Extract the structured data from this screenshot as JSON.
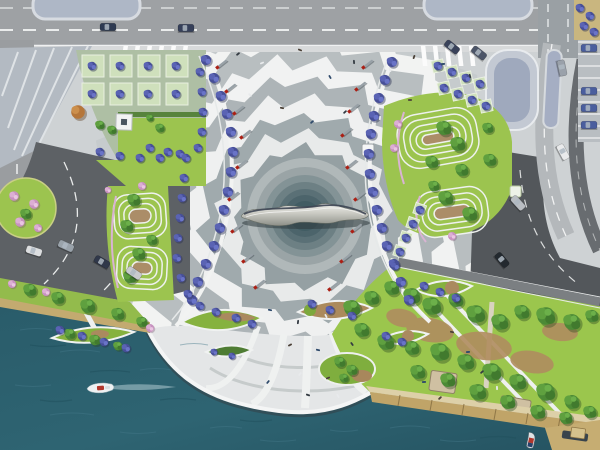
{
  "meta": {
    "title": "Aerial masterplan rendering: waterfront civic plaza with ripple paving, central metallic sculpture, landscaped terraces, roads and harbour",
    "view": "top-down site plan"
  },
  "palette": {
    "plaza_base": "#ced2d4",
    "plaza_white": "#f2f3f2",
    "plaza_gray": "#b4babc",
    "water": "#2c606e",
    "lawn": "#9cc44f",
    "road_light": "#9ea1a4",
    "road_dark": "#5d6165",
    "beach": "#c3aa70",
    "boardwalk": "#c0a468",
    "tree_green": "#4f8f3a",
    "tree_blue": "#5b62aa",
    "tree_pink": "#d9aed2",
    "mast_red": "#ab1f14",
    "metal": "#c9c9c2"
  },
  "scene": {
    "ripple": {
      "cx": 305,
      "cy": 218,
      "rings": [
        {
          "r": 208,
          "amp": 16,
          "teeth": 27,
          "rot": 4,
          "color": "#c6cbcd"
        },
        {
          "r": 188,
          "amp": 15,
          "teeth": 25,
          "rot": 11,
          "color": "#f2f3f2"
        },
        {
          "r": 168,
          "amp": 15,
          "teeth": 23,
          "rot": 1,
          "color": "#b8bec0"
        },
        {
          "r": 149,
          "amp": 14,
          "teeth": 21,
          "rot": 8,
          "color": "#f1f2f2"
        },
        {
          "r": 131,
          "amp": 13,
          "teeth": 19,
          "rot": 15,
          "color": "#adb4b7"
        },
        {
          "r": 113,
          "amp": 12,
          "teeth": 17,
          "rot": 5,
          "color": "#eff0f0"
        },
        {
          "r": 96,
          "amp": 11,
          "teeth": 15,
          "rot": 12,
          "color": "#a0aaad"
        },
        {
          "r": 80,
          "amp": 10,
          "teeth": 13,
          "rot": 3,
          "color": "#e8eaea"
        },
        {
          "r": 65,
          "amp": 9,
          "teeth": 12,
          "rot": 9,
          "color": "#95a0a3"
        }
      ],
      "core": [
        [
          58,
          "#b0b8b9"
        ],
        [
          49,
          "#9aa4a6"
        ],
        [
          41,
          "#839396"
        ],
        [
          34,
          "#6d8084"
        ],
        [
          27,
          "#5a7076"
        ],
        [
          21,
          "#4c646b"
        ],
        [
          15,
          "#415c63"
        ]
      ]
    },
    "masts": [
      [
        222,
        64
      ],
      [
        231,
        88
      ],
      [
        239,
        110
      ],
      [
        246,
        134
      ],
      [
        242,
        164
      ],
      [
        234,
        196
      ],
      [
        237,
        228
      ],
      [
        248,
        258
      ],
      [
        260,
        284
      ],
      [
        368,
        64
      ],
      [
        361,
        86
      ],
      [
        354,
        108
      ],
      [
        347,
        132
      ],
      [
        352,
        164
      ],
      [
        360,
        196
      ],
      [
        357,
        228
      ],
      [
        346,
        258
      ],
      [
        334,
        286
      ]
    ],
    "cars": [
      [
        108,
        27,
        0,
        "#2e3a52"
      ],
      [
        186,
        28,
        0,
        "#36405a"
      ],
      [
        452,
        47,
        38,
        "#39425a"
      ],
      [
        479,
        53,
        38,
        "#4c5568"
      ],
      [
        563,
        152,
        62,
        "#e9eaeb"
      ],
      [
        518,
        203,
        48,
        "#b9bdc2"
      ],
      [
        562,
        68,
        78,
        "#9aa1aa"
      ],
      [
        34,
        251,
        18,
        "#dcdee0"
      ],
      [
        66,
        246,
        24,
        "#9aa3ab"
      ],
      [
        102,
        262,
        30,
        "#30384a"
      ],
      [
        134,
        273,
        34,
        "#c8cace"
      ],
      [
        502,
        260,
        50,
        "#23292f"
      ]
    ],
    "parked_cars": [
      [
        589,
        48
      ],
      [
        589,
        91
      ],
      [
        589,
        108
      ],
      [
        589,
        125
      ]
    ],
    "people": [
      [
        238,
        54
      ],
      [
        262,
        63
      ],
      [
        300,
        50
      ],
      [
        330,
        77
      ],
      [
        354,
        62
      ],
      [
        390,
        70
      ],
      [
        414,
        57
      ],
      [
        443,
        64
      ],
      [
        470,
        76
      ],
      [
        250,
        95
      ],
      [
        282,
        108
      ],
      [
        312,
        122
      ],
      [
        345,
        112
      ],
      [
        380,
        118
      ],
      [
        410,
        100
      ],
      [
        270,
        310
      ],
      [
        298,
        322
      ],
      [
        326,
        316
      ],
      [
        290,
        345
      ],
      [
        318,
        350
      ],
      [
        352,
        344
      ],
      [
        300,
        374
      ],
      [
        328,
        378
      ],
      [
        268,
        382
      ],
      [
        308,
        395
      ],
      [
        338,
        396
      ],
      [
        452,
        332
      ],
      [
        468,
        352
      ],
      [
        482,
        372
      ],
      [
        497,
        388
      ],
      [
        440,
        398
      ],
      [
        424,
        382
      ]
    ],
    "trees": {
      "green": [
        [
          352,
          308,
          9
        ],
        [
          372,
          298,
          8
        ],
        [
          392,
          288,
          8
        ],
        [
          412,
          296,
          9
        ],
        [
          432,
          306,
          10
        ],
        [
          456,
          300,
          8
        ],
        [
          476,
          314,
          10
        ],
        [
          500,
          322,
          9
        ],
        [
          522,
          312,
          8
        ],
        [
          546,
          316,
          10
        ],
        [
          572,
          322,
          9
        ],
        [
          592,
          316,
          7
        ],
        [
          362,
          330,
          8
        ],
        [
          386,
          342,
          9
        ],
        [
          412,
          348,
          8
        ],
        [
          440,
          352,
          10
        ],
        [
          466,
          362,
          9
        ],
        [
          492,
          372,
          10
        ],
        [
          518,
          382,
          9
        ],
        [
          546,
          392,
          10
        ],
        [
          572,
          402,
          8
        ],
        [
          590,
          412,
          7
        ],
        [
          418,
          372,
          8
        ],
        [
          448,
          380,
          8
        ],
        [
          478,
          392,
          9
        ],
        [
          508,
          402,
          8
        ],
        [
          538,
          412,
          8
        ],
        [
          566,
          418,
          7
        ],
        [
          444,
          128,
          8
        ],
        [
          458,
          144,
          8
        ],
        [
          432,
          162,
          7
        ],
        [
          462,
          170,
          7
        ],
        [
          446,
          198,
          8
        ],
        [
          470,
          214,
          8
        ],
        [
          434,
          186,
          6
        ],
        [
          490,
          160,
          7
        ],
        [
          488,
          128,
          6
        ],
        [
          134,
          200,
          7
        ],
        [
          127,
          226,
          7
        ],
        [
          139,
          254,
          7
        ],
        [
          130,
          277,
          7
        ],
        [
          152,
          240,
          6
        ],
        [
          30,
          290,
          7
        ],
        [
          58,
          298,
          7
        ],
        [
          88,
          306,
          8
        ],
        [
          118,
          314,
          7
        ],
        [
          142,
          322,
          6
        ],
        [
          26,
          214,
          6
        ],
        [
          340,
          362,
          6
        ],
        [
          352,
          370,
          6
        ],
        [
          344,
          378,
          5
        ],
        [
          70,
          334,
          6
        ],
        [
          95,
          340,
          6
        ],
        [
          118,
          346,
          5
        ],
        [
          100,
          125,
          5
        ],
        [
          112,
          130,
          5
        ],
        [
          160,
          128,
          5
        ],
        [
          150,
          118,
          4
        ]
      ],
      "blue": [
        [
          206,
          60,
          6
        ],
        [
          214,
          78,
          6
        ],
        [
          221,
          96,
          6
        ],
        [
          227,
          114,
          6
        ],
        [
          231,
          132,
          6
        ],
        [
          233,
          152,
          6
        ],
        [
          231,
          172,
          6
        ],
        [
          228,
          192,
          6
        ],
        [
          224,
          210,
          6
        ],
        [
          220,
          228,
          6
        ],
        [
          214,
          246,
          6
        ],
        [
          206,
          264,
          6
        ],
        [
          198,
          282,
          6
        ],
        [
          192,
          300,
          6
        ],
        [
          392,
          62,
          6
        ],
        [
          385,
          80,
          6
        ],
        [
          379,
          98,
          6
        ],
        [
          374,
          116,
          6
        ],
        [
          371,
          134,
          6
        ],
        [
          369,
          154,
          6
        ],
        [
          370,
          174,
          6
        ],
        [
          373,
          192,
          6
        ],
        [
          377,
          210,
          6
        ],
        [
          382,
          228,
          6
        ],
        [
          387,
          246,
          6
        ],
        [
          394,
          264,
          6
        ],
        [
          401,
          282,
          6
        ],
        [
          409,
          300,
          6
        ],
        [
          100,
          152,
          5
        ],
        [
          120,
          156,
          5
        ],
        [
          140,
          158,
          5
        ],
        [
          160,
          158,
          5
        ],
        [
          180,
          154,
          5
        ],
        [
          198,
          148,
          5
        ],
        [
          200,
          72,
          5
        ],
        [
          202,
          92,
          5
        ],
        [
          203,
          112,
          5
        ],
        [
          202,
          132,
          5
        ],
        [
          92,
          66,
          5
        ],
        [
          120,
          66,
          5
        ],
        [
          148,
          66,
          5
        ],
        [
          176,
          66,
          5
        ],
        [
          92,
          94,
          5
        ],
        [
          120,
          94,
          5
        ],
        [
          148,
          94,
          5
        ],
        [
          176,
          94,
          5
        ],
        [
          438,
          66,
          5
        ],
        [
          452,
          72,
          5
        ],
        [
          466,
          78,
          5
        ],
        [
          480,
          84,
          5
        ],
        [
          444,
          88,
          5
        ],
        [
          458,
          94,
          5
        ],
        [
          472,
          100,
          5
        ],
        [
          486,
          106,
          5
        ],
        [
          420,
          210,
          5
        ],
        [
          413,
          224,
          5
        ],
        [
          406,
          238,
          5
        ],
        [
          400,
          252,
          5
        ],
        [
          395,
          266,
          5
        ],
        [
          150,
          148,
          5
        ],
        [
          168,
          152,
          5
        ],
        [
          186,
          158,
          5
        ],
        [
          184,
          178,
          5
        ],
        [
          182,
          198,
          5
        ],
        [
          180,
          218,
          5
        ],
        [
          178,
          238,
          5
        ],
        [
          177,
          258,
          5
        ],
        [
          181,
          278,
          5
        ],
        [
          188,
          294,
          5
        ],
        [
          200,
          306,
          5
        ],
        [
          216,
          312,
          5
        ],
        [
          236,
          318,
          5
        ],
        [
          252,
          324,
          5
        ],
        [
          312,
          304,
          5
        ],
        [
          330,
          310,
          5
        ],
        [
          352,
          316,
          5
        ],
        [
          424,
          286,
          5
        ],
        [
          440,
          292,
          5
        ],
        [
          456,
          298,
          5
        ],
        [
          386,
          336,
          5
        ],
        [
          402,
          342,
          5
        ],
        [
          60,
          330,
          5
        ],
        [
          82,
          336,
          5
        ],
        [
          104,
          342,
          5
        ],
        [
          126,
          348,
          5
        ],
        [
          214,
          352,
          4
        ],
        [
          232,
          356,
          4
        ],
        [
          580,
          8,
          5
        ],
        [
          590,
          16,
          5
        ],
        [
          584,
          26,
          5
        ],
        [
          594,
          32,
          5
        ]
      ],
      "pink": [
        [
          14,
          196,
          6
        ],
        [
          34,
          204,
          6
        ],
        [
          20,
          222,
          6
        ],
        [
          38,
          228,
          5
        ],
        [
          12,
          284,
          5
        ],
        [
          46,
          292,
          5
        ],
        [
          150,
          328,
          5
        ],
        [
          398,
          124,
          5
        ],
        [
          394,
          148,
          5
        ],
        [
          142,
          186,
          5
        ],
        [
          108,
          190,
          4
        ],
        [
          452,
          236,
          5
        ]
      ],
      "orange": [
        [
          78,
          112,
          8
        ]
      ]
    },
    "boats": {
      "harbour_boat": {
        "x": 100,
        "y": 388
      },
      "pier_boat": {
        "x": 531,
        "y": 441
      }
    },
    "kiosks": [
      [
        362,
        144
      ],
      [
        510,
        186
      ]
    ],
    "monument": {
      "x": 116,
      "y": 114
    }
  }
}
